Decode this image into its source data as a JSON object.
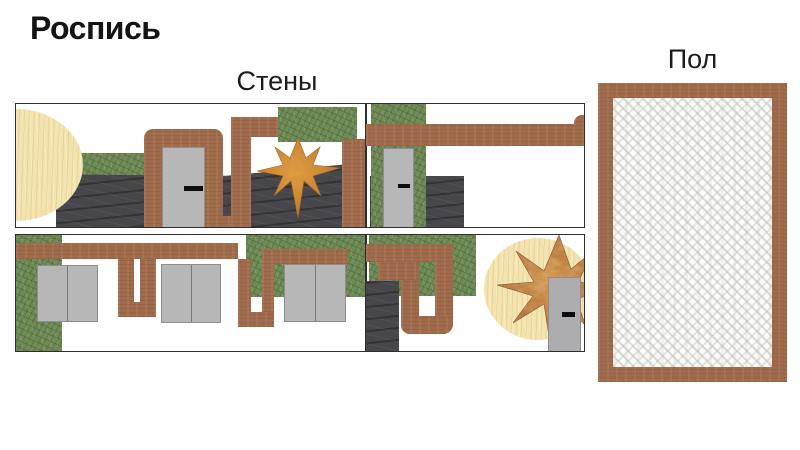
{
  "title": "Роспись",
  "sections": {
    "walls_label": "Стены",
    "floor_label": "Пол"
  },
  "palette": {
    "brown": "#a06b4c",
    "green": "#6f8c57",
    "slate": "#47474b",
    "cream": "#f3e3ae",
    "door_gray": "#b7b7b7",
    "star_orange": "#d98a2b",
    "star_marble_brown": "#8f4e1e",
    "floor_weave": "#d9d9d3",
    "border_dark": "#2e2e2e",
    "text": "#111111"
  }
}
